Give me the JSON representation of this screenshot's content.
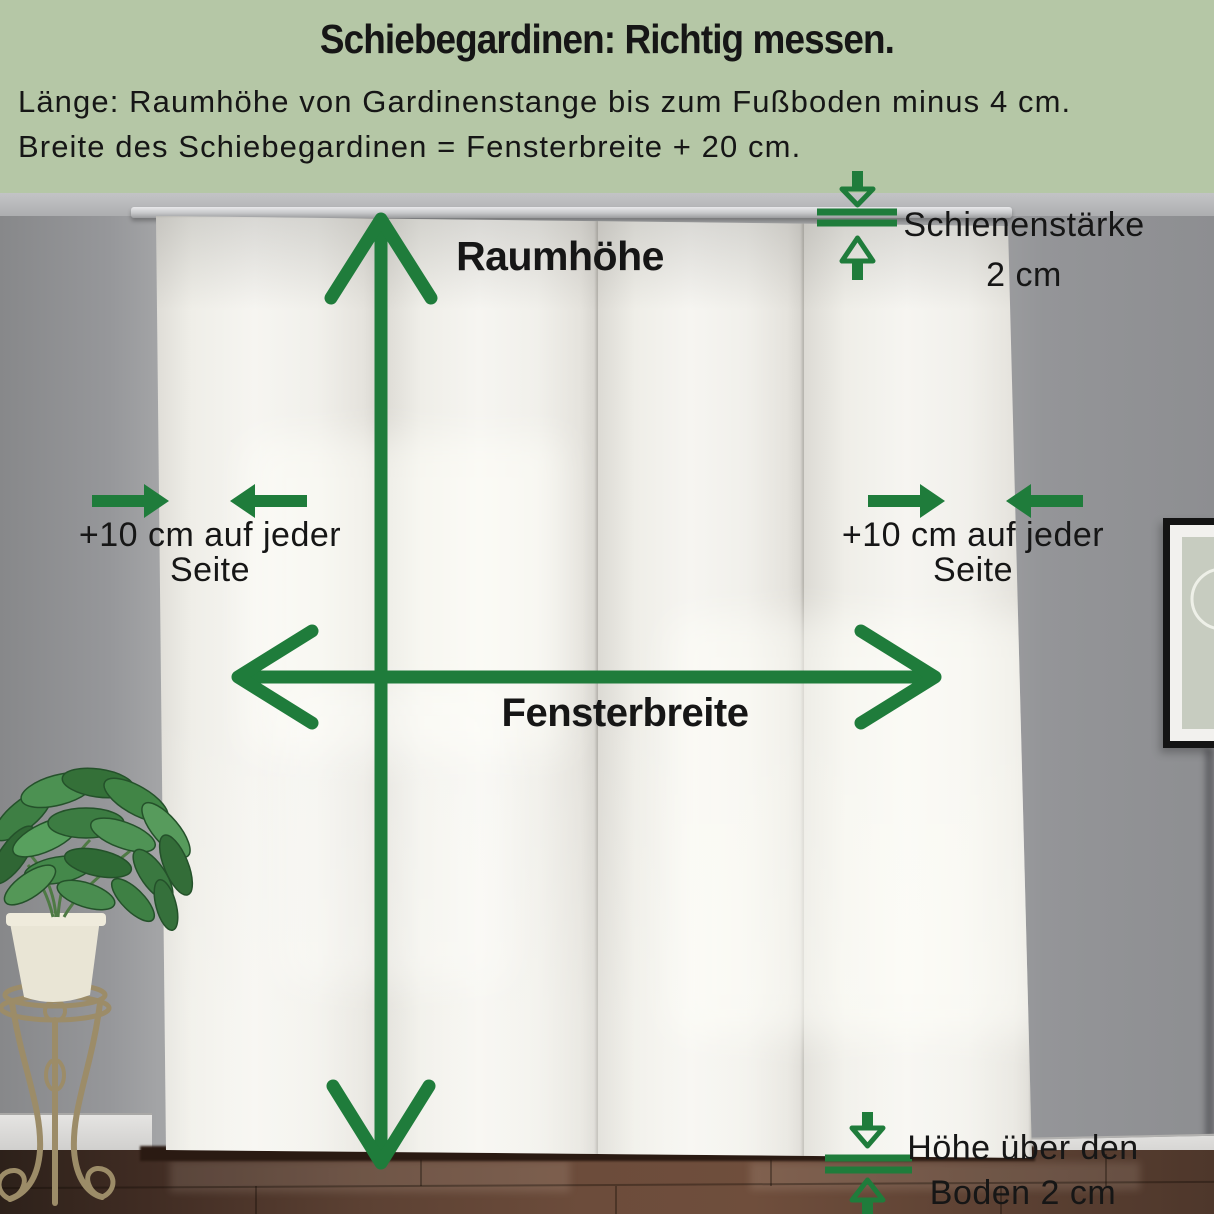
{
  "header": {
    "title": "Schiebegardinen: Richtig messen.",
    "instruction_line_1": "Länge: Raumhöhe von Gardinenstange bis zum Fußboden minus 4 cm.",
    "instruction_line_2": "Breite des Schiebegardinen = Fensterbreite + 20 cm."
  },
  "diagram": {
    "room_height_label": "Raumhöhe",
    "window_width_label": "Fensterbreite",
    "left_offset": {
      "line1": "+10 cm auf jeder",
      "line2": "Seite"
    },
    "right_offset": {
      "line1": "+10 cm auf jeder",
      "line2": "Seite"
    },
    "rail_thickness": {
      "line1": "Schienenstärke",
      "line2": "2 cm"
    },
    "floor_clearance": {
      "line1": "Höhe über den",
      "line2": "Boden 2 cm"
    }
  },
  "icons": {
    "room_height_arrow": "vertical-double-arrow-icon",
    "window_width_arrow": "horizontal-double-arrow-icon",
    "left_offset_arrows": "inward-pointing-arrows-icon",
    "right_offset_arrows": "inward-pointing-arrows-icon",
    "rail_thickness_arrows": "vertical-pinch-arrows-icon",
    "floor_clearance_arrows": "vertical-pinch-arrows-icon"
  },
  "colors": {
    "accent_green": "#1f7c3b",
    "header_background": "#b5c7a6",
    "text_color": "#161616"
  }
}
